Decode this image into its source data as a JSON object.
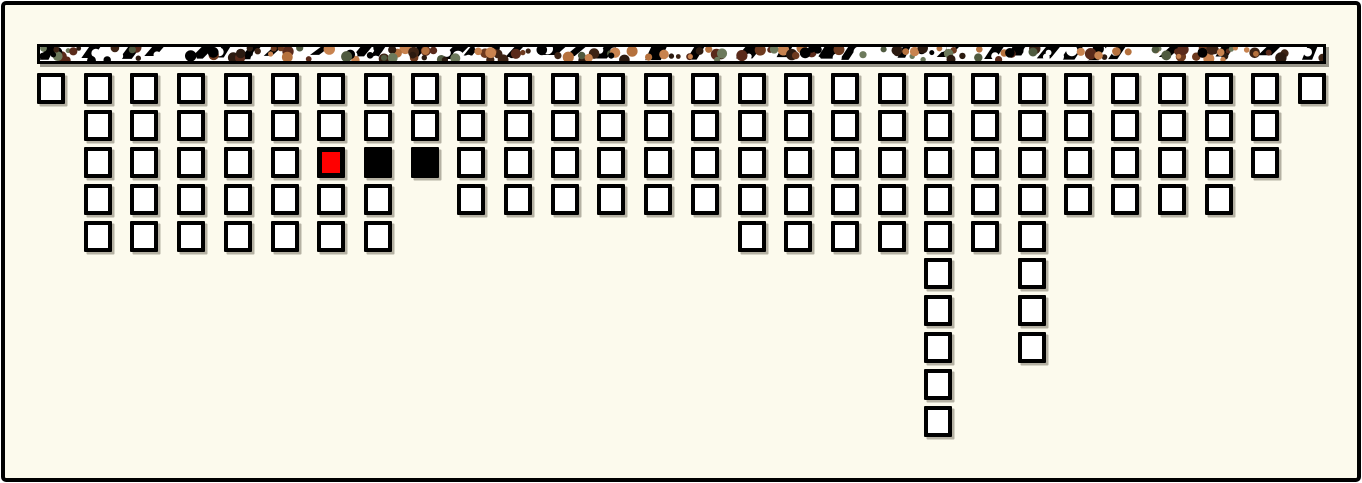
{
  "window": {
    "background_color": "#fcfaed",
    "frame_border_color": "#000000"
  },
  "banner": {
    "x": 37,
    "y": 44,
    "width": 1289,
    "height": 20,
    "border_color": "#000000",
    "background_color": "#ffffff",
    "blob_palette": [
      "#000000",
      "#3d2314",
      "#6e3a1e",
      "#b5713d",
      "#c8834f",
      "#6d7a5c",
      "#4f5a3f",
      "#5a2a1a",
      "#2b1a10"
    ]
  },
  "grid": {
    "origin_x": 37,
    "origin_y": 73,
    "col_pitch": 46.7,
    "row_pitch": 37,
    "cell_width": 28,
    "cell_height": 31,
    "column_cell_counts": [
      1,
      5,
      5,
      5,
      5,
      5,
      5,
      5,
      3,
      4,
      4,
      4,
      4,
      4,
      4,
      5,
      5,
      5,
      5,
      10,
      5,
      8,
      4,
      4,
      4,
      4,
      3,
      1
    ],
    "cell_states": {
      "empty": {
        "color": "#ffffff",
        "border_color": "#000000",
        "label": "empty"
      },
      "selected": {
        "color": "#ff0000",
        "border_color": "#000000",
        "label": "selected"
      },
      "occupied": {
        "color": "#000000",
        "border_color": "#000000",
        "label": "occupied"
      }
    },
    "marked_cells": [
      {
        "col": 6,
        "row": 2,
        "state": "selected"
      },
      {
        "col": 7,
        "row": 2,
        "state": "occupied"
      },
      {
        "col": 8,
        "row": 2,
        "state": "occupied"
      }
    ]
  },
  "chart_data": {
    "type": "unit-grid",
    "title": "",
    "categories": [
      0,
      1,
      2,
      3,
      4,
      5,
      6,
      7,
      8,
      9,
      10,
      11,
      12,
      13,
      14,
      15,
      16,
      17,
      18,
      19,
      20,
      21,
      22,
      23,
      24,
      25,
      26,
      27
    ],
    "values": [
      1,
      5,
      5,
      5,
      5,
      5,
      5,
      5,
      3,
      4,
      4,
      4,
      4,
      4,
      4,
      5,
      5,
      5,
      5,
      10,
      5,
      8,
      4,
      4,
      4,
      4,
      3,
      1
    ],
    "highlights": [
      {
        "col": 6,
        "row": 2,
        "color": "#ff0000"
      },
      {
        "col": 7,
        "row": 2,
        "color": "#000000"
      },
      {
        "col": 8,
        "row": 2,
        "color": "#000000"
      }
    ]
  }
}
